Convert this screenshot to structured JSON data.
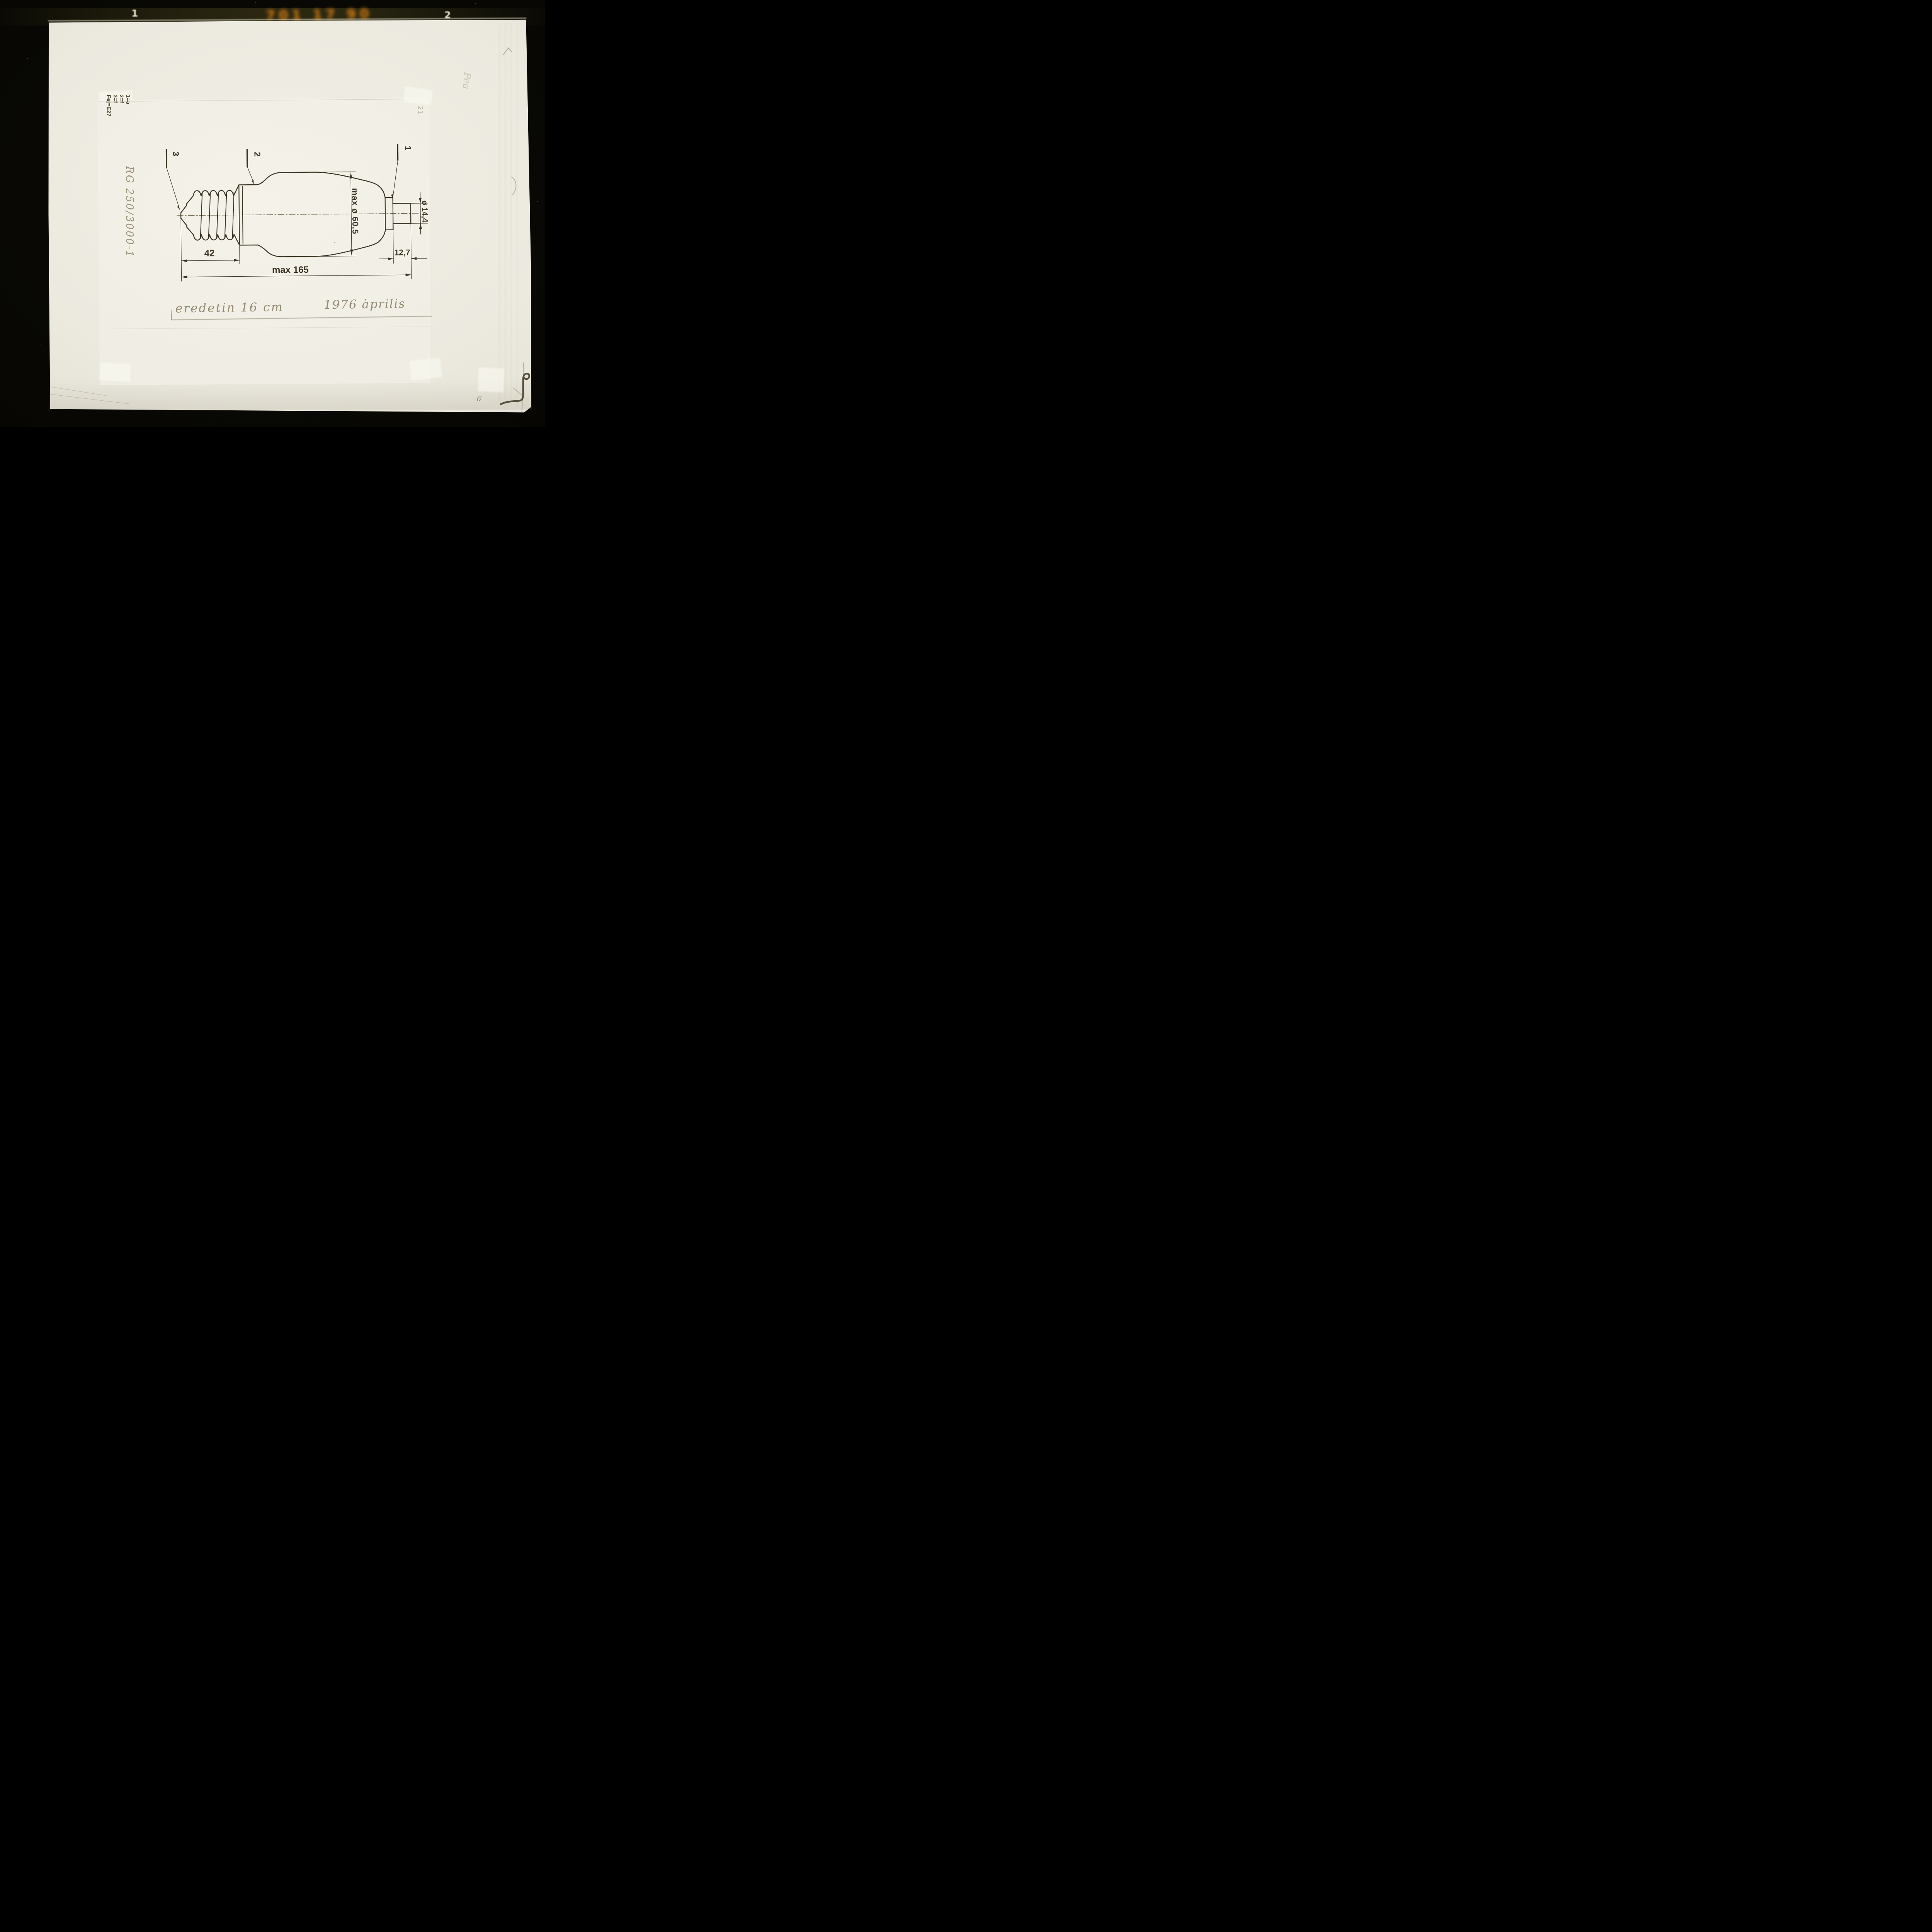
{
  "film": {
    "frame_left": "1",
    "frame_right": "2",
    "edge_code": "701 17 90"
  },
  "legend": {
    "line1": "1=a",
    "line2": "2=f",
    "line3": "3=f",
    "line4": "Fej=E27"
  },
  "part_code": "RG 250/3000-1",
  "drawing": {
    "callout_1": "1",
    "callout_2": "2",
    "callout_3": "3",
    "dim_max_diameter": "max ø 60,5",
    "dim_tip_diameter": "ø 14,4",
    "dim_base_length": "42",
    "dim_tip_length": "12,7",
    "dim_total_length": "max 165"
  },
  "handnote": {
    "text": "eredetin 16 cm",
    "date": "1976 àprilis"
  },
  "pencil": {
    "sheet_number": "21",
    "edge_signature": "Pea",
    "corner_mark": "6"
  },
  "colors": {
    "ink": "#3a3323",
    "paper": "#e9e6da",
    "film_black": "#080704",
    "marking_orange": "#ff9211"
  }
}
